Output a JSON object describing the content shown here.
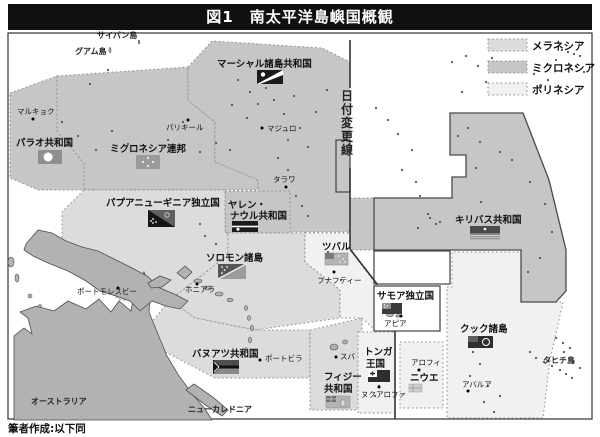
{
  "title": {
    "text": "図1　南太平洋島嶼国概観"
  },
  "caption": {
    "text": "筆者作成:以下同"
  },
  "legend": {
    "items": [
      {
        "label": "メラネシア",
        "key": "mel"
      },
      {
        "label": "ミクロネシア",
        "key": "mic"
      },
      {
        "label": "ポリネシア",
        "key": "pol"
      }
    ]
  },
  "palette": {
    "mel": "#dcdcdc",
    "mic": "#c6c6c6",
    "pol": "#f1f1f1",
    "white": "#ffffff",
    "land": "#b2b2b2",
    "landStroke": "#4f4f4f",
    "dotted": "#8c8c8c",
    "solid": "#4a4a4a",
    "dot": "#555555",
    "text": "#111111",
    "dateline": "#333333"
  },
  "map": {
    "regions": [
      {
        "n": "palau-region",
        "f": "mic",
        "s": "dot",
        "p": "10,93 57,76 57,131 84,163 84,190 38,190 10,178"
      },
      {
        "n": "micronesia-fsm-region",
        "f": "mic",
        "s": "dot",
        "p": "57,76 188,67 188,100 215,122 215,162 258,180 258,190 84,190 84,163 57,131"
      },
      {
        "n": "marshall-gilbert-region",
        "f": "mic",
        "s": "dot",
        "p": "188,67 212,41 322,48 350,62 350,232 258,232 258,180 215,162 215,122 188,100"
      },
      {
        "n": "gilbert-south-strip",
        "f": "mic",
        "s": "dot",
        "p": "350,198 374,198 374,250 350,250"
      },
      {
        "n": "nauru-region",
        "f": "mic",
        "s": "dot",
        "p": "225,191 290,191 290,233 225,233"
      },
      {
        "n": "png-region",
        "f": "mel",
        "s": "dot",
        "p": "84,190 225,190 225,233 228,233 228,255 170,300 120,300 62,258 62,212"
      },
      {
        "n": "solomon-region",
        "f": "mel",
        "s": "dot",
        "p": "228,233 305,233 305,262 340,290 340,318 255,330 195,318 170,300 228,255"
      },
      {
        "n": "vanuatu-region",
        "f": "mel",
        "s": "dot",
        "p": "170,300 195,318 255,330 310,330 310,378 215,378 152,345 152,322"
      },
      {
        "n": "fiji-region",
        "f": "mel",
        "s": "dot",
        "p": "310,330 362,318 362,410 310,410"
      },
      {
        "n": "tuvalu-region",
        "f": "pol",
        "s": "dot",
        "p": "305,233 350,233 350,250 377,285 377,332 362,318 340,318 340,290 305,262"
      },
      {
        "n": "tonga-region",
        "f": "pol",
        "s": "dot",
        "p": "358,332 395,332 395,413 358,413"
      },
      {
        "n": "niue-region",
        "f": "pol",
        "s": "dot",
        "p": "400,342 443,342 443,408 400,408"
      },
      {
        "n": "cook-region",
        "f": "pol",
        "s": "dot",
        "p": "447,287 452,287 452,252 521,252 521,302 563,302 550,360 543,418 447,418"
      },
      {
        "n": "kiribati-region",
        "f": "mic",
        "s": "solid",
        "p": "450,113 523,113 549,180 566,250 566,291 556,302 521,302 521,250 374,250 374,198 452,198 452,177 466,177 466,155 450,155"
      },
      {
        "n": "kiribati-west-notch",
        "f": "mic",
        "s": "solid",
        "p": "336,140 350,140 350,192 336,192"
      },
      {
        "n": "tokelau-white-box",
        "f": "white",
        "s": "solid",
        "p": "374,251 450,251 450,284 374,284"
      },
      {
        "n": "samoa-white-box",
        "f": "white",
        "s": "solid",
        "p": "374,286 440,286 440,331 374,331"
      }
    ],
    "lands": [
      {
        "n": "australia",
        "p": "14,420 14,336 24,328 32,334 28,318 20,312 36,306 54,311 68,301 86,309 99,299 111,312 119,301 131,311 136,284 144,272 151,290 149,312 157,332 167,356 179,376 194,396 205,409 212,420"
      },
      {
        "n": "new-guinea",
        "p": "26,244 38,230 52,233 66,241 82,247 98,251 114,259 130,267 147,276 160,288 174,294 188,301 180,309 166,306 152,301 140,311 130,301 116,296 100,291 86,281 68,271 48,263 33,256 24,250"
      },
      {
        "n": "new-britain",
        "p": "148,283 160,276 171,280 162,287 151,288"
      },
      {
        "n": "bougainville",
        "p": "177,273 185,266 192,272 185,279"
      },
      {
        "n": "new-caledonia",
        "p": "186,390 194,384 214,398 228,410 222,416 204,404"
      },
      {
        "n": "solomon-island",
        "e": [
          198,
          281,
          4,
          2
        ]
      },
      {
        "n": "solomon-island",
        "e": [
          208,
          288,
          4,
          2
        ]
      },
      {
        "n": "solomon-island",
        "e": [
          219,
          294,
          4,
          2
        ]
      },
      {
        "n": "solomon-island",
        "e": [
          230,
          300,
          3,
          1.8
        ]
      },
      {
        "n": "vanuatu-island",
        "e": [
          246,
          308,
          1.5,
          2.5
        ]
      },
      {
        "n": "vanuatu-island",
        "e": [
          249,
          318,
          1.5,
          2.5
        ]
      },
      {
        "n": "vanuatu-island",
        "e": [
          252,
          328,
          1.5,
          3
        ]
      },
      {
        "n": "vanuatu-island",
        "e": [
          250,
          340,
          1.5,
          3
        ]
      },
      {
        "n": "vanuatu-island",
        "e": [
          246,
          350,
          1.5,
          2.5
        ]
      },
      {
        "n": "fiji-island",
        "e": [
          334,
          347,
          4,
          3
        ]
      },
      {
        "n": "fiji-island",
        "e": [
          345,
          342,
          2.5,
          2
        ]
      },
      {
        "n": "samoa-island",
        "e": [
          390,
          315,
          3.5,
          1.6
        ]
      },
      {
        "n": "samoa-island",
        "e": [
          398,
          316,
          2.2,
          1.2
        ]
      },
      {
        "n": "maluku-island",
        "e": [
          11,
          262,
          3,
          5
        ]
      },
      {
        "n": "maluku-island",
        "e": [
          17,
          278,
          2,
          4
        ]
      },
      {
        "n": "small-island",
        "e": [
          30,
          296,
          2,
          2
        ]
      },
      {
        "n": "small-island",
        "e": [
          40,
          306,
          1.5,
          1.5
        ]
      },
      {
        "n": "guam-island",
        "e": [
          110,
          50,
          1,
          2.5
        ]
      },
      {
        "n": "saipan-island",
        "e": [
          139,
          42,
          0.8,
          1.8
        ]
      }
    ],
    "dots": [
      [
        62,
        122
      ],
      [
        78,
        136
      ],
      [
        96,
        150
      ],
      [
        112,
        131
      ],
      [
        128,
        144
      ],
      [
        149,
        156
      ],
      [
        168,
        140
      ],
      [
        183,
        122
      ],
      [
        140,
        166
      ],
      [
        200,
        152
      ],
      [
        216,
        143
      ],
      [
        90,
        84
      ],
      [
        108,
        70
      ],
      [
        238,
        80
      ],
      [
        250,
        92
      ],
      [
        258,
        104
      ],
      [
        266,
        88
      ],
      [
        274,
        100
      ],
      [
        284,
        114
      ],
      [
        294,
        96
      ],
      [
        300,
        128
      ],
      [
        288,
        140
      ],
      [
        308,
        147
      ],
      [
        316,
        112
      ],
      [
        327,
        90
      ],
      [
        247,
        118
      ],
      [
        232,
        105
      ],
      [
        278,
        158
      ],
      [
        288,
        170
      ],
      [
        296,
        196
      ],
      [
        302,
        206
      ],
      [
        308,
        216
      ],
      [
        230,
        150
      ],
      [
        468,
        128
      ],
      [
        458,
        136
      ],
      [
        480,
        142
      ],
      [
        500,
        152
      ],
      [
        476,
        168
      ],
      [
        530,
        182
      ],
      [
        545,
        204
      ],
      [
        552,
        232
      ],
      [
        540,
        258
      ],
      [
        528,
        272
      ],
      [
        481,
        202
      ],
      [
        512,
        160
      ],
      [
        388,
        120
      ],
      [
        398,
        134
      ],
      [
        412,
        150
      ],
      [
        376,
        108
      ],
      [
        402,
        170
      ],
      [
        416,
        182
      ],
      [
        420,
        196
      ],
      [
        428,
        214
      ],
      [
        436,
        224
      ],
      [
        418,
        228
      ],
      [
        452,
        62
      ],
      [
        466,
        56
      ],
      [
        478,
        66
      ],
      [
        492,
        58
      ],
      [
        506,
        70
      ],
      [
        520,
        62
      ],
      [
        534,
        74
      ],
      [
        514,
        86
      ],
      [
        486,
        82
      ],
      [
        462,
        92
      ],
      [
        548,
        80
      ],
      [
        556,
        60
      ],
      [
        562,
        50
      ],
      [
        568,
        52
      ],
      [
        574,
        54
      ],
      [
        580,
        56
      ],
      [
        576,
        66
      ],
      [
        584,
        72
      ],
      [
        328,
        252
      ],
      [
        334,
        262
      ],
      [
        341,
        280
      ],
      [
        377,
        376
      ],
      [
        379,
        386
      ],
      [
        375,
        396
      ],
      [
        473,
        352
      ],
      [
        480,
        364
      ],
      [
        470,
        376
      ],
      [
        488,
        386
      ],
      [
        484,
        402
      ],
      [
        494,
        412
      ],
      [
        500,
        396
      ],
      [
        536,
        358
      ],
      [
        544,
        362
      ],
      [
        552,
        366
      ],
      [
        560,
        370
      ],
      [
        566,
        374
      ],
      [
        572,
        378
      ],
      [
        530,
        352
      ],
      [
        564,
        352
      ],
      [
        573,
        362
      ],
      [
        580,
        368
      ],
      [
        556,
        338
      ],
      [
        563,
        343
      ],
      [
        570,
        348
      ],
      [
        205,
        236
      ],
      [
        216,
        244
      ],
      [
        200,
        224
      ],
      [
        430,
        218
      ],
      [
        440,
        222
      ]
    ],
    "dateline": {
      "label": "日付変更線",
      "label_x": 347,
      "label_y": 100,
      "dy": 13.5,
      "segs": [
        [
          350,
          40,
          350,
          88
        ],
        [
          350,
          168,
          350,
          249
        ],
        [
          350,
          249,
          377,
          284
        ],
        [
          395,
          331,
          395,
          419
        ]
      ]
    },
    "flags": [
      {
        "t": "palau",
        "x": 38,
        "y": 150,
        "w": 24,
        "h": 14
      },
      {
        "t": "fsm",
        "x": 136,
        "y": 155,
        "w": 24,
        "h": 14
      },
      {
        "t": "marshall",
        "x": 257,
        "y": 70,
        "w": 26,
        "h": 14
      },
      {
        "t": "nauru",
        "x": 232,
        "y": 221,
        "w": 26,
        "h": 11
      },
      {
        "t": "png",
        "x": 148,
        "y": 210,
        "w": 27,
        "h": 17
      },
      {
        "t": "solomon",
        "x": 218,
        "y": 264,
        "w": 28,
        "h": 15
      },
      {
        "t": "kiribati",
        "x": 470,
        "y": 226,
        "w": 30,
        "h": 14
      },
      {
        "t": "tuvalu",
        "x": 325,
        "y": 253,
        "w": 23,
        "h": 12
      },
      {
        "t": "vanuatu",
        "x": 213,
        "y": 360,
        "w": 26,
        "h": 14
      },
      {
        "t": "fiji",
        "x": 326,
        "y": 396,
        "w": 24,
        "h": 12
      },
      {
        "t": "samoa",
        "x": 382,
        "y": 303,
        "w": 20,
        "h": 11
      },
      {
        "t": "tonga",
        "x": 368,
        "y": 370,
        "w": 22,
        "h": 12
      },
      {
        "t": "niue",
        "x": 409,
        "y": 384,
        "w": 13,
        "h": 8
      },
      {
        "t": "cook",
        "x": 468,
        "y": 336,
        "w": 25,
        "h": 12
      }
    ],
    "capital_dots": [
      [
        33,
        119
      ],
      [
        188,
        120
      ],
      [
        262,
        128
      ],
      [
        286,
        187
      ],
      [
        118,
        288
      ],
      [
        197,
        284
      ],
      [
        260,
        360
      ],
      [
        336,
        357
      ],
      [
        334,
        272
      ],
      [
        401,
        316
      ],
      [
        379,
        387
      ],
      [
        419,
        370
      ],
      [
        468,
        391
      ]
    ],
    "labels": [
      {
        "t": "パラオ共和国",
        "x": 16,
        "y": 146,
        "c": "country"
      },
      {
        "t": "ミクロネシア連邦",
        "x": 110,
        "y": 152,
        "c": "country"
      },
      {
        "t": "マーシャル諸島共和国",
        "x": 217,
        "y": 67,
        "c": "country"
      },
      {
        "t": "ヤレン・",
        "x": 228,
        "y": 208,
        "c": "country"
      },
      {
        "t": "ナウル共和国",
        "x": 230,
        "y": 219,
        "c": "country"
      },
      {
        "t": "キリバス共和国",
        "x": 455,
        "y": 223,
        "c": "country"
      },
      {
        "t": "パプアニューギニア独立国",
        "x": 106,
        "y": 206,
        "c": "country"
      },
      {
        "t": "ソロモン諸島",
        "x": 206,
        "y": 261,
        "c": "country"
      },
      {
        "t": "ツバル",
        "x": 322,
        "y": 250,
        "c": "country"
      },
      {
        "t": "バヌアツ共和国",
        "x": 192,
        "y": 357,
        "c": "country"
      },
      {
        "t": "フィジー",
        "x": 324,
        "y": 380,
        "c": "country"
      },
      {
        "t": "共和国",
        "x": 324,
        "y": 392,
        "c": "country"
      },
      {
        "t": "サモア独立国",
        "x": 377,
        "y": 299,
        "c": "country"
      },
      {
        "t": "トンガ",
        "x": 364,
        "y": 355,
        "c": "country"
      },
      {
        "t": "王国",
        "x": 366,
        "y": 367,
        "c": "country"
      },
      {
        "t": "ニウエ",
        "x": 410,
        "y": 381,
        "c": "country",
        "s": 8
      },
      {
        "t": "クック諸島",
        "x": 460,
        "y": 332,
        "c": "country"
      },
      {
        "t": "マルキョク",
        "x": 17,
        "y": 114,
        "c": "city"
      },
      {
        "t": "パリキール",
        "x": 166,
        "y": 130,
        "c": "city"
      },
      {
        "t": "マジュロ",
        "x": 267,
        "y": 131,
        "c": "city"
      },
      {
        "t": "タラワ",
        "x": 273,
        "y": 182,
        "c": "city"
      },
      {
        "t": "ポートモレスビー",
        "x": 77,
        "y": 294,
        "c": "city"
      },
      {
        "t": "ホニアラ",
        "x": 185,
        "y": 292,
        "c": "city"
      },
      {
        "t": "ポートビラ",
        "x": 265,
        "y": 361,
        "c": "city"
      },
      {
        "t": "スバ",
        "x": 340,
        "y": 359,
        "c": "city"
      },
      {
        "t": "フナフティー",
        "x": 317,
        "y": 283,
        "c": "city"
      },
      {
        "t": "アピア",
        "x": 384,
        "y": 326,
        "c": "city"
      },
      {
        "t": "ヌクアロファ",
        "x": 361,
        "y": 397,
        "c": "city"
      },
      {
        "t": "アロフィ",
        "x": 411,
        "y": 365,
        "c": "city"
      },
      {
        "t": "アバルア",
        "x": 462,
        "y": 387,
        "c": "city"
      },
      {
        "t": "サイパン島",
        "x": 97,
        "y": 38,
        "c": "place"
      },
      {
        "t": "グアム島",
        "x": 75,
        "y": 54,
        "c": "place"
      },
      {
        "t": "ニューカレドニア",
        "x": 188,
        "y": 412,
        "c": "place",
        "s": 8.5
      },
      {
        "t": "オーストラリア",
        "x": 31,
        "y": 404,
        "c": "place",
        "s": 10
      },
      {
        "t": "タヒチ島",
        "x": 543,
        "y": 363,
        "c": "place",
        "s": 8.5
      }
    ]
  }
}
